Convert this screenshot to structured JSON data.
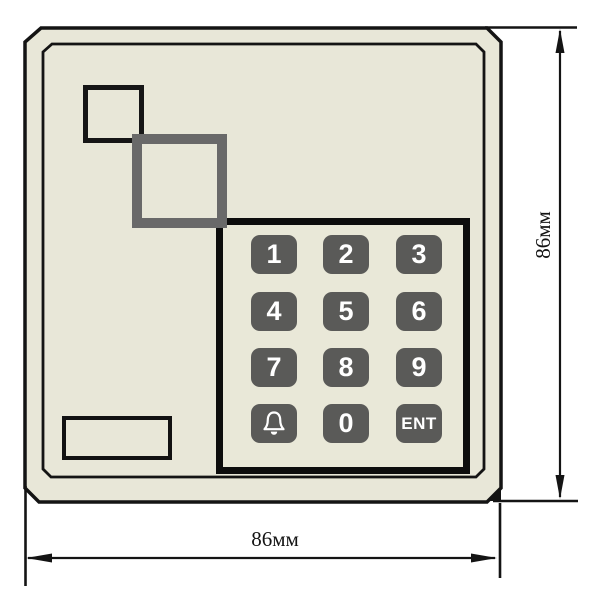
{
  "figure": {
    "description_visible": "dimensioned drawing of an access-control keypad panel"
  },
  "keypad": {
    "keys": [
      {
        "label": "1"
      },
      {
        "label": "2"
      },
      {
        "label": "3"
      },
      {
        "label": "4"
      },
      {
        "label": "5"
      },
      {
        "label": "6"
      },
      {
        "label": "7"
      },
      {
        "label": "8"
      },
      {
        "label": "9"
      },
      {
        "label": "",
        "icon": "bell-icon"
      },
      {
        "label": "0"
      },
      {
        "label": "ENT"
      }
    ]
  },
  "dimensions": {
    "height_label": "86мм",
    "width_label": "86мм"
  },
  "colors": {
    "body_fill": "#e8e7d8",
    "outline": "#141414",
    "key_fill": "#5a5a58",
    "key_text": "#ffffff",
    "gray_square": "#696969",
    "keypad_inner_fill": "#e9e8d8",
    "background": "#ffffff"
  }
}
